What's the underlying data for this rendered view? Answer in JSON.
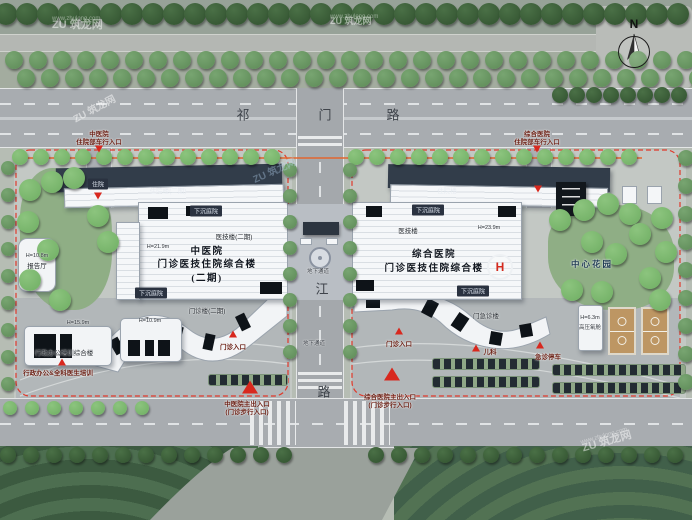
{
  "watermark": {
    "brand": "ZU 筑龙网",
    "url": "www.zhulong.com"
  },
  "compass": {
    "label": "N"
  },
  "colors": {
    "marker_red": "#d8281e",
    "boundary_red": "#e0392b",
    "street_line_orange": "#e2662f",
    "water_blue": "#2f63a4",
    "tree_green": "#6fae63",
    "roof_dark": "#323d4a"
  },
  "roads": {
    "top_road_name": "祁门路",
    "vertical_road_chars": [
      "江",
      "路"
    ],
    "underpass": "地下通道"
  },
  "labels": [
    {
      "name": "road-qimen-char-1",
      "text": "祁",
      "x": 243,
      "y": 114,
      "cls": "roadchar"
    },
    {
      "name": "road-qimen-char-2",
      "text": "门",
      "x": 325,
      "y": 114,
      "cls": "roadchar"
    },
    {
      "name": "road-qimen-char-3",
      "text": "路",
      "x": 393,
      "y": 114,
      "cls": "roadchar"
    },
    {
      "name": "road-vert-char-1",
      "text": "江",
      "x": 322,
      "y": 288,
      "cls": "roadchar"
    },
    {
      "name": "road-vert-char-2",
      "text": "路",
      "x": 324,
      "y": 391,
      "cls": "roadchar"
    },
    {
      "name": "underpass-label-top",
      "text": "地下通道",
      "x": 318,
      "y": 271,
      "cls": "micro"
    },
    {
      "name": "underpass-label-bottom",
      "text": "地下通道",
      "x": 314,
      "y": 343,
      "cls": "micro"
    },
    {
      "name": "left-inpatient-drive-line1",
      "text": "中医院",
      "x": 99,
      "y": 133,
      "cls": "entr"
    },
    {
      "name": "left-inpatient-drive-line2",
      "text": "住院部车行入口",
      "x": 99,
      "y": 141,
      "cls": "entr"
    },
    {
      "name": "right-inpatient-drive-line1",
      "text": "综合医院",
      "x": 537,
      "y": 133,
      "cls": "entr"
    },
    {
      "name": "right-inpatient-drive-line2",
      "text": "住院部车行入口",
      "x": 537,
      "y": 141,
      "cls": "entr"
    },
    {
      "name": "left-inpatient-chip",
      "text": "住院",
      "x": 98,
      "y": 184,
      "cls": "chip"
    },
    {
      "name": "left-inpatient-wing-label",
      "text": "住院楼(二期)",
      "x": 168,
      "y": 190,
      "cls": "onroof"
    },
    {
      "name": "right-inpatient-wing-label",
      "text": "住院楼",
      "x": 447,
      "y": 190,
      "cls": "onroof"
    },
    {
      "name": "left-sunken-courtyard-top",
      "text": "下沉庭院",
      "x": 206,
      "y": 211,
      "cls": "chip"
    },
    {
      "name": "left-sunken-courtyard-bottom",
      "text": "下沉庭院",
      "x": 151,
      "y": 293,
      "cls": "chip"
    },
    {
      "name": "right-sunken-courtyard-top",
      "text": "下沉庭院",
      "x": 428,
      "y": 210,
      "cls": "chip"
    },
    {
      "name": "right-sunken-courtyard-bottom",
      "text": "下沉庭院",
      "x": 473,
      "y": 291,
      "cls": "chip"
    },
    {
      "name": "left-medtech-label",
      "text": "医技楼(二期)",
      "x": 234,
      "y": 236,
      "cls": "tiny"
    },
    {
      "name": "left-medtech-height",
      "text": "H=21.9m",
      "x": 158,
      "y": 247,
      "cls": "hnum"
    },
    {
      "name": "right-medtech-label",
      "text": "医技楼",
      "x": 408,
      "y": 230,
      "cls": "tiny"
    },
    {
      "name": "right-medtech-height",
      "text": "H=23.9m",
      "x": 489,
      "y": 228,
      "cls": "hnum"
    },
    {
      "name": "left-hospital-title-line1",
      "text": "中医院",
      "x": 207,
      "y": 250,
      "cls": "title"
    },
    {
      "name": "left-hospital-title-line2",
      "text": "门诊医技住院综合楼",
      "x": 207,
      "y": 263,
      "cls": "title"
    },
    {
      "name": "left-hospital-title-line3",
      "text": "(二期)",
      "x": 207,
      "y": 277,
      "cls": "title"
    },
    {
      "name": "right-hospital-title-line1",
      "text": "综合医院",
      "x": 434,
      "y": 253,
      "cls": "title"
    },
    {
      "name": "right-hospital-title-line2",
      "text": "门诊医技住院综合楼",
      "x": 434,
      "y": 267,
      "cls": "title"
    },
    {
      "name": "left-outpatient-wing-label",
      "text": "门诊楼(二期)",
      "x": 207,
      "y": 310,
      "cls": "tiny"
    },
    {
      "name": "right-outpatient-wing-label",
      "text": "门急诊楼",
      "x": 486,
      "y": 315,
      "cls": "tiny"
    },
    {
      "name": "left-outpatient-entrance",
      "text": "门诊入口",
      "x": 233,
      "y": 346,
      "cls": "entr"
    },
    {
      "name": "right-outpatient-entrance",
      "text": "门诊入口",
      "x": 399,
      "y": 343,
      "cls": "entr"
    },
    {
      "name": "pediatrics-label",
      "text": "儿科",
      "x": 490,
      "y": 351,
      "cls": "entr"
    },
    {
      "name": "emergency-parking-label",
      "text": "急诊停车",
      "x": 548,
      "y": 356,
      "cls": "entr"
    },
    {
      "name": "left-main-entrance-line1",
      "text": "中医院主出入口",
      "x": 247,
      "y": 403,
      "cls": "entr"
    },
    {
      "name": "left-main-entrance-line2",
      "text": "(门诊步行入口)",
      "x": 247,
      "y": 411,
      "cls": "entr"
    },
    {
      "name": "right-main-entrance-line1",
      "text": "综合医院主出入口",
      "x": 390,
      "y": 396,
      "cls": "entr"
    },
    {
      "name": "right-main-entrance-line2",
      "text": "(门诊步行入口)",
      "x": 390,
      "y": 404,
      "cls": "entr"
    },
    {
      "name": "report-hall-height",
      "text": "H=10.8m",
      "x": 37,
      "y": 256,
      "cls": "hnum"
    },
    {
      "name": "report-hall-label",
      "text": "报告厅",
      "x": 37,
      "y": 265,
      "cls": "tiny"
    },
    {
      "name": "admin-building-height",
      "text": "H=15.9m",
      "x": 78,
      "y": 323,
      "cls": "hnum"
    },
    {
      "name": "admin-building-label",
      "text": "行政办公培训综合楼",
      "x": 64,
      "y": 352,
      "cls": "tiny"
    },
    {
      "name": "admin-building-caption",
      "text": "行政办公&全科医生培训",
      "x": 58,
      "y": 372,
      "cls": "entr"
    },
    {
      "name": "outpatient2-height",
      "text": "H=10.9m",
      "x": 150,
      "y": 321,
      "cls": "hnum"
    },
    {
      "name": "central-garden-label",
      "text": "中心花园",
      "x": 592,
      "y": 264,
      "cls": "garden-lbl"
    },
    {
      "name": "oxygen-chamber-height",
      "text": "H=6.3m",
      "x": 590,
      "y": 318,
      "cls": "hnum"
    },
    {
      "name": "oxygen-chamber-label",
      "text": "高压氧舱",
      "x": 590,
      "y": 327,
      "cls": "micro"
    }
  ]
}
